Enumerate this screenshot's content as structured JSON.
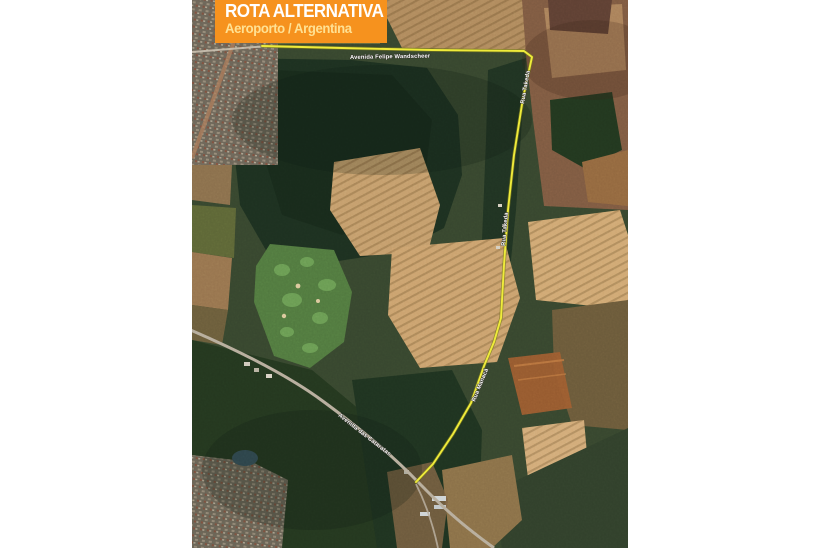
{
  "banner": {
    "title": "ROTA ALTERNATIVA",
    "subtitle": "Aeroporto / Argentina",
    "background_color": "#F6921E",
    "title_color": "#FFFFFF",
    "subtitle_color": "#FFE193"
  },
  "map": {
    "route_color": "#EFEB3B",
    "street_labels": {
      "avenida_felipe_wandscheer": "Avenida Felipe Wandscheer",
      "rua_vertical_north": "Rua Takeda",
      "rua_vertical_mid": "Rua Takeda",
      "rua_vertical_south": "Rua Manacá",
      "avenida_das_cataratas": "Avenida das Cataratas"
    }
  }
}
